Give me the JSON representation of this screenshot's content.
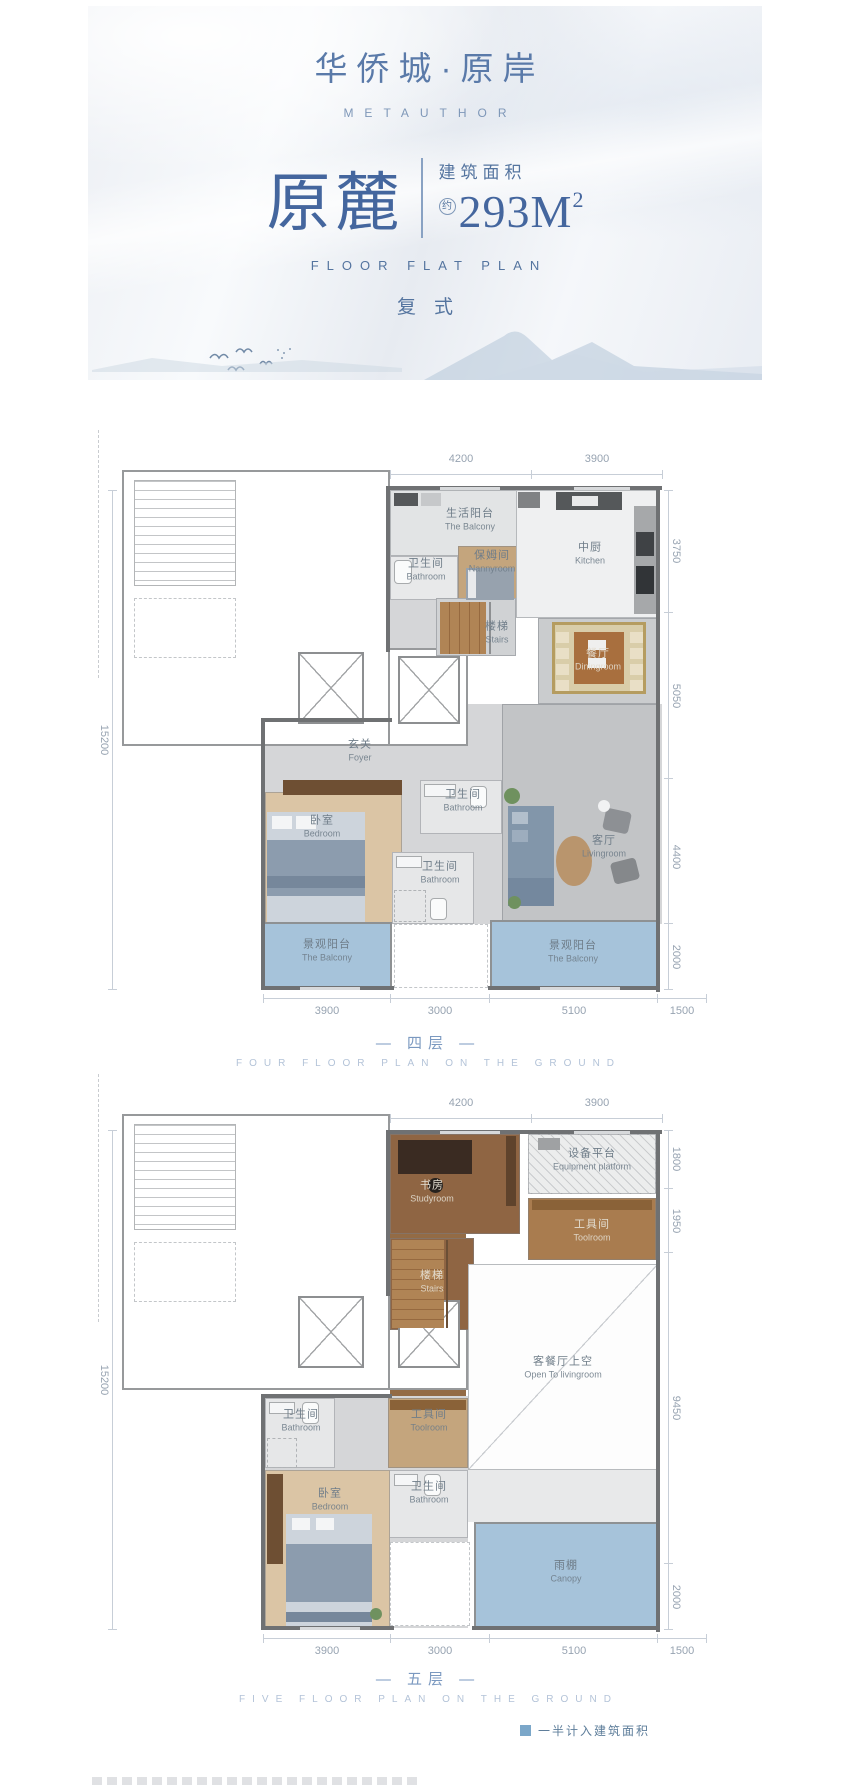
{
  "header": {
    "logo_cn": "华侨城·原岸",
    "logo_en": "METAUTHOR",
    "unit_name": "原麓",
    "area_label": "建筑面积",
    "area_prefix": "约",
    "area_value": "293M",
    "area_exponent": "2",
    "plan_type_en": "FLOOR FLAT PLAN",
    "plan_type_cn": "复式"
  },
  "floor4": {
    "caption_cn": "— 四层 —",
    "caption_en": "FOUR FLOOR PLAN ON THE GROUND",
    "dims": {
      "top": [
        "4200",
        "3900"
      ],
      "right": [
        "3750",
        "5050",
        "4400",
        "2000"
      ],
      "left": [
        "15200"
      ],
      "bottom": [
        "3900",
        "3000",
        "5100",
        "1500"
      ]
    },
    "rooms": {
      "service_balcony": {
        "cn": "生活阳台",
        "en": "The Balcony"
      },
      "bath_service": {
        "cn": "卫生间",
        "en": "Bathroom"
      },
      "nanny": {
        "cn": "保姆间",
        "en": "Nannyroom"
      },
      "kitchen": {
        "cn": "中厨",
        "en": "Kitchen"
      },
      "stairs": {
        "cn": "楼梯",
        "en": "Stairs"
      },
      "dining": {
        "cn": "餐厅",
        "en": "Diningroom"
      },
      "foyer": {
        "cn": "玄关",
        "en": "Foyer"
      },
      "bath_hall": {
        "cn": "卫生间",
        "en": "Bathroom"
      },
      "bedroom": {
        "cn": "卧室",
        "en": "Bedroom"
      },
      "bath_lower": {
        "cn": "卫生间",
        "en": "Bathroom"
      },
      "living": {
        "cn": "客厅",
        "en": "Livingroom"
      },
      "balcony_left": {
        "cn": "景观阳台",
        "en": "The Balcony"
      },
      "balcony_right": {
        "cn": "景观阳台",
        "en": "The Balcony"
      }
    }
  },
  "floor5": {
    "caption_cn": "— 五层 —",
    "caption_en": "FIVE FLOOR PLAN ON THE GROUND",
    "dims": {
      "top": [
        "4200",
        "3900"
      ],
      "right": [
        "1800",
        "1950",
        "9450",
        "2000"
      ],
      "left": [
        "15200"
      ],
      "bottom": [
        "3900",
        "3000",
        "5100",
        "1500"
      ]
    },
    "rooms": {
      "study": {
        "cn": "书房",
        "en": "Studyroom"
      },
      "equipment": {
        "cn": "设备平台",
        "en": "Equipment platform"
      },
      "tool_upper": {
        "cn": "工具间",
        "en": "Toolroom"
      },
      "stairs": {
        "cn": "楼梯",
        "en": "Stairs"
      },
      "void": {
        "cn": "客餐厅上空",
        "en": "Open To livingroom"
      },
      "bath_left": {
        "cn": "卫生间",
        "en": "Bathroom"
      },
      "tool_lower": {
        "cn": "工具间",
        "en": "Toolroom"
      },
      "bath_mid": {
        "cn": "卫生间",
        "en": "Bathroom"
      },
      "bedroom": {
        "cn": "卧室",
        "en": "Bedroom"
      },
      "canopy": {
        "cn": "雨棚",
        "en": "Canopy"
      }
    }
  },
  "legend": {
    "half_area_label": "一半计入建筑面积"
  },
  "colors": {
    "brand_blue": "#44669e",
    "text_blue": "#54749f",
    "dim_gray": "#97a3b1",
    "balcony_blue": "#a6c3da",
    "legend_blue": "#7ba7c9",
    "wall_dark": "#6f7173"
  }
}
